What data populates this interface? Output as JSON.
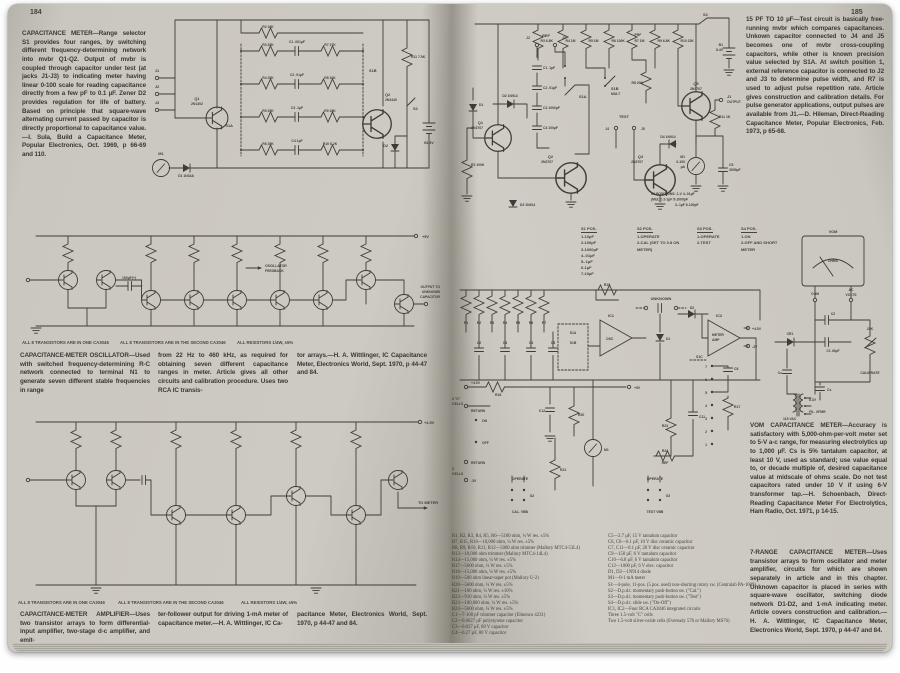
{
  "left_page": {
    "page_number": "184",
    "intro": "CAPACITANCE METER—Range selector S1 provides four ranges, by switching different frequency-determining network into mvbr Q1-Q2. Output of mvbr is coupled through capacitor under test (at jacks J1-J3) to indicating meter having linear 0-100 scale for reading capacitance directly from a few pF to 0.1 µF. Zener D2 provides regulation for life of battery. Based on principle that square-wave alternating current passed by capacitor is directly proportional to capacitance value.—I. Sula, Build a Capacitance Meter, Popular Electronics, Oct. 1969, p 66-69 and 110.",
    "notes": {
      "one_ca3046": "ALL 8 TRANSISTORS ARE IN ONE CA3046",
      "second_ca3046": "ALL 8 TRANSISTORS ARE IN THE SECOND CA3046",
      "resistors": "ALL RESISTORS 1/4W, ±5%"
    },
    "oscillator_caption": {
      "col1": "CAPACITANCE-METER OSCILLATOR—Used with switched frequency-determining R-C network connected to terminal N1 to generate seven different stable frequencies in range",
      "col2": "from 22 Hz to 460 kHz, as required for obtaining seven different capacitance ranges in meter. Article gives all other circuits and calibration procedure. Uses two RCA IC transis-",
      "col3": "tor arrays.—H. A. Wittlinger, IC Capacitance Meter, Electronics World, Sept. 1970, p 44-47 and 84."
    },
    "amplifier_caption": {
      "col1": "CAPACITANCE-METER AMPLIFIER—Uses two transistor arrays to form differential-input amplifier, two-stage d-c amplifier, and emit-",
      "col2": "ter-follower output for driving 1-mA meter of capacitance meter.—H. A. Wittlinger, IC Ca-",
      "col3": "pacitance Meter, Electronics World, Sept. 1970, p 44-47 and 84."
    },
    "schematic_meter": {
      "q1": "Q1",
      "q1_type": "2N1302",
      "q2": "Q2",
      "q2_type": "2N2440",
      "s1a": "S1A",
      "s1b": "S1B",
      "s2": "S2",
      "r2": "R2 18K",
      "r3": "R3 25K",
      "r4": "R4 25K",
      "r5": "R5 25K",
      "r6": "R6 25K",
      "r7": "R7 27K",
      "r8": "R8 10K",
      "r9": "R9 18K",
      "r10": "R10 8.2K",
      "r11": "R11 7.5K",
      "c1": "C1 .001µF",
      "c2": "C2 .01µF",
      "c3": "C3 .1µF",
      "c4": "C4 1µF",
      "d1": "D1 1N34A",
      "d2": "D2",
      "m1": "M1",
      "b1": "B1 9V",
      "j1": "J1",
      "j2": "J2",
      "j3": "J3"
    },
    "schematic_oscillator": {
      "supply": "+5V",
      "feedback_1": "OSCILLATOR",
      "feedback_2": "FEEDBACK",
      "output_1": "OUTPUT TO",
      "output_2": "UNKNOWN",
      "output_3": "CAPACITOR",
      "cap150": "150µF(+)"
    },
    "schematic_amplifier": {
      "supply": "+4.5V",
      "to_meter": "TO METER"
    }
  },
  "right_page": {
    "page_number": "185",
    "intro": "15 PF TO 10 µF—Test circuit is basically free-running mvbr which compares capacitances. Unkown capacitor connected to J4 and J5 becomes one of mvbr cross-coupling capacitors, while other is known precision value selected by S1A. At switch position 1, external reference capacitor is connected to J2 and J3 to determine pulse width, and R7 is used to adjust pulse repetition rate. Article gives construction and calibration details. For pulse generator applications, output pulses are available from J1.—D. Hileman, Direct-Reading Capacitance Meter, Popular Electronics, Feb. 1973, p 65-68.",
    "vom_caption": "VOM CAPACITANCE METER—Accuracy is satisfactory with 5,000-ohm-per-volt meter set to 5-V a-c range, for measuring electrolytics up to 1,000 µF. Cs is 5% tantalum capacitor, at least 10 V, used as standard; use value equal to, or decade multiple of, desired capacitance value at midscale of ohms scale. Do not test capacitors rated under 10 V if using 6-V transformer tap.—H. Schoenbach, Direct-Reading Capacitance Meter For Electrolytics, Ham Radio, Oct. 1971, p 14-15.",
    "range7_caption": "7-RANGE CAPACITANCE METER—Uses transistor arrays to form oscillator and meter amplifier, circuits for which are shown separately in article and in this chapter. Unknown capacitor is placed in series with square-wave oscillator, switching diode network D1-D2, and 1-mA indicating meter. Article covers construction and calibration.—H. A. Wittlinger, IC Capacitance Meter, Electronics World, Sept. 1970, p 44-47 and 84.",
    "parts_list": {
      "col1": [
        "R1, R2, R3, R4, R5, R6—5100 ohm, ¼ W res. ±5%",
        "R7, R15, R16—10,000 ohm, ¼ W res. ±5%",
        "R8, R9, R10, R11, R12—5000 ohm trimmer (Mallory MTC4-53L4)",
        "R13—10,000 ohm trimmer (Mallory MTC4-14L4)",
        "R14—15,000 ohm, ¼ W res. ±5%",
        "R17—5600 ohm, ¼ W res. ±5%",
        "R18—15,000 ohm, ¼ W res. ±5%",
        "R19—500 ohm linear-taper pot (Mallory U-2)",
        "R20—5600 ohm, ¼ W res. ±5%",
        "R21—100 ohm, ¼ W res. ±10%",
        "R22—910 ohm, ¼ W res. ±5%",
        "R23—100,000 ohm, ¼ W res. ±5%",
        "R24—5600 ohm, ¼ W res. ±5%",
        "C1—7-100 pF trimmer capacitor (Elmenco 4231)",
        "C2—0.0027 µF polystyrene capacitor",
        "C3—0.027 µF, 80 V capacitor",
        "C4—0.27 µF, 80 V capacitor"
      ],
      "col2": [
        "C5—2.7 µF, 15 V tantalum capacitor",
        "C6, C8—0.1 µF, 10 V disc ceramic capacitor",
        "C7, C11—0.1 µF, 20 V disc ceramic capacitor",
        "C9—150 µF, 6 V tantalum capacitor",
        "C10—6.8 µF, 6 V tantalum capacitor",
        "C12—1000 µF, 6 V elec. capacitor",
        "D1, D2—1N914 diode",
        "M1—0-1 mA meter",
        "S1—4-pole, 11-pos. (5 pos. used) non-shorting rotary sw. (Centralab PA-1009)",
        "S2—D.p.d.t. momentary push-button sw. (\"Cal.\")",
        "S3—D.p.d.t. momentary push-button sw. (\"Test\")",
        "S4—D.p.d.t. slide sw. (\"On-Off\")",
        "IC1, IC2—Four RCA CA3046 integrated circuits",
        "Three 1.5-volt \"C\" cells",
        "Two 1.5-volt silver-oxide cells (Eveready 576 or Mallory MS76)"
      ]
    },
    "switch_tables": {
      "s1": {
        "header": "S1 POS.",
        "rows": [
          "1-10pF",
          "2-100pF",
          "3-1000pF",
          "4-.01µF",
          "5-.1µF",
          "6-1µF",
          "7-10µF"
        ]
      },
      "s2": {
        "header": "S2 POS.",
        "rows": [
          "1-OPERATE",
          "2-CAL (SET TO 0.8 ON METER)"
        ]
      },
      "s3": {
        "header": "S3 POS.",
        "rows": [
          "1-OPERATE",
          "2-TEST"
        ]
      },
      "s4": {
        "header": "S4 POS.",
        "rows": [
          "1-ON",
          "2-OFF AND SHORT METER"
        ]
      }
    },
    "schematic_mvbr": {
      "q1": "Q1",
      "q1_type": "2N3707",
      "q2": "Q2",
      "q2_type": "2N3707",
      "q3": "Q3",
      "q3_type": "2N3707",
      "q5": "Q5",
      "q5_type": "2N3707",
      "ref": "REF",
      "test": "TEST",
      "j1": "J1",
      "output": "OUTPUT",
      "j2": "J2",
      "j3": "J3",
      "j4": "J4",
      "j5": "J5",
      "s1a": "S1A",
      "s1b": "S1B",
      "mult": "MULT",
      "s2": "S2",
      "b1": "B1",
      "b1v": "8.4V",
      "r2": "R2 100K",
      "r3": "R3 6.8K",
      "r4": "R4 1M",
      "r5": "R5 1M",
      "r6": "R6 100K",
      "prf": "PRF",
      "r7": "R7 1M",
      "r8": "R8 20K",
      "r9": "R9 6.8K",
      "r10": "R10 22K",
      "r11": "R11 1K",
      "c1": "C1 .1µF",
      "c2": "C2 .01µF",
      "c3": "C3 1000pF",
      "c4": "C4 100µF",
      "c5": "C5",
      "c5v": "3000µF",
      "d1": "D1",
      "d2": "D2 1N914",
      "d3": "D3 1N914",
      "d4": "D4 1N914",
      "m1": "M1",
      "m1_scale": "0-100",
      "m1_unit": "µA",
      "pos1": "S1 POSITIONS: 1-V  4-.01µF",
      "pos2": "(MULT)  2-1µF  5-1000pF",
      "pos3": "3-.1µF  6-100pF"
    },
    "schematic_ic_meter": {
      "unknown": "UNKNOWN",
      "ic1": "IC1",
      "osc": "OSC",
      "ic2": "IC2",
      "amp1": "METER",
      "amp2": "AMP",
      "p45": "+4.5V",
      "m3": "-3V",
      "p45b": "+4.5V",
      "p5": "+5V",
      "return1": "RETURN",
      "return2": "RETURN",
      "m3b": "-3V",
      "cells1a": "3 \"C\"",
      "cells1b": "CELLS",
      "cells2a": "2",
      "cells2b": "CELLS",
      "on": "ON",
      "off": "OFF",
      "r1": "R1",
      "r2": "R2",
      "r3": "R3",
      "r4": "R4",
      "r5": "R5",
      "r6": "R6",
      "r7": "R7",
      "c2": "C2",
      "c3": "C3",
      "c4": "C4",
      "c5": "C5",
      "r18": "R18",
      "r19": "R19",
      "r20": "R20",
      "r21": "R21",
      "r23": "R23",
      "r24": "R24",
      "ref": "REF",
      "c12": "C12",
      "c11": "C11",
      "c8": "C8",
      "r17": "R17",
      "d1": "D1",
      "d2": "D2",
      "s1a": "S1A",
      "s1b": "S1B",
      "s1c": "S1C",
      "s2": "S2",
      "s3": "S3",
      "operate1": "OPERATE",
      "operate2": "OPERATE",
      "cal": "CAL. VBB",
      "testv": "TEST VBB",
      "m1": "M1",
      "nums": [
        "7",
        "6",
        "5",
        "4",
        "3",
        "2",
        "1"
      ]
    },
    "schematic_vom": {
      "vom": "VOM",
      "ohms": "OHMS",
      "com": "COM",
      "ac": "AC",
      "volts": "VOLTS",
      "c2": "C2",
      "c1": "C1 40µF",
      "cr1": "CR1",
      "pot": "25K",
      "calibrate": "CALIBRATE",
      "cx": "Cx",
      "cs": "Cs",
      "v63": "6.3V",
      "fil": "FIL. XFMR",
      "vac": "115 VAC"
    }
  }
}
